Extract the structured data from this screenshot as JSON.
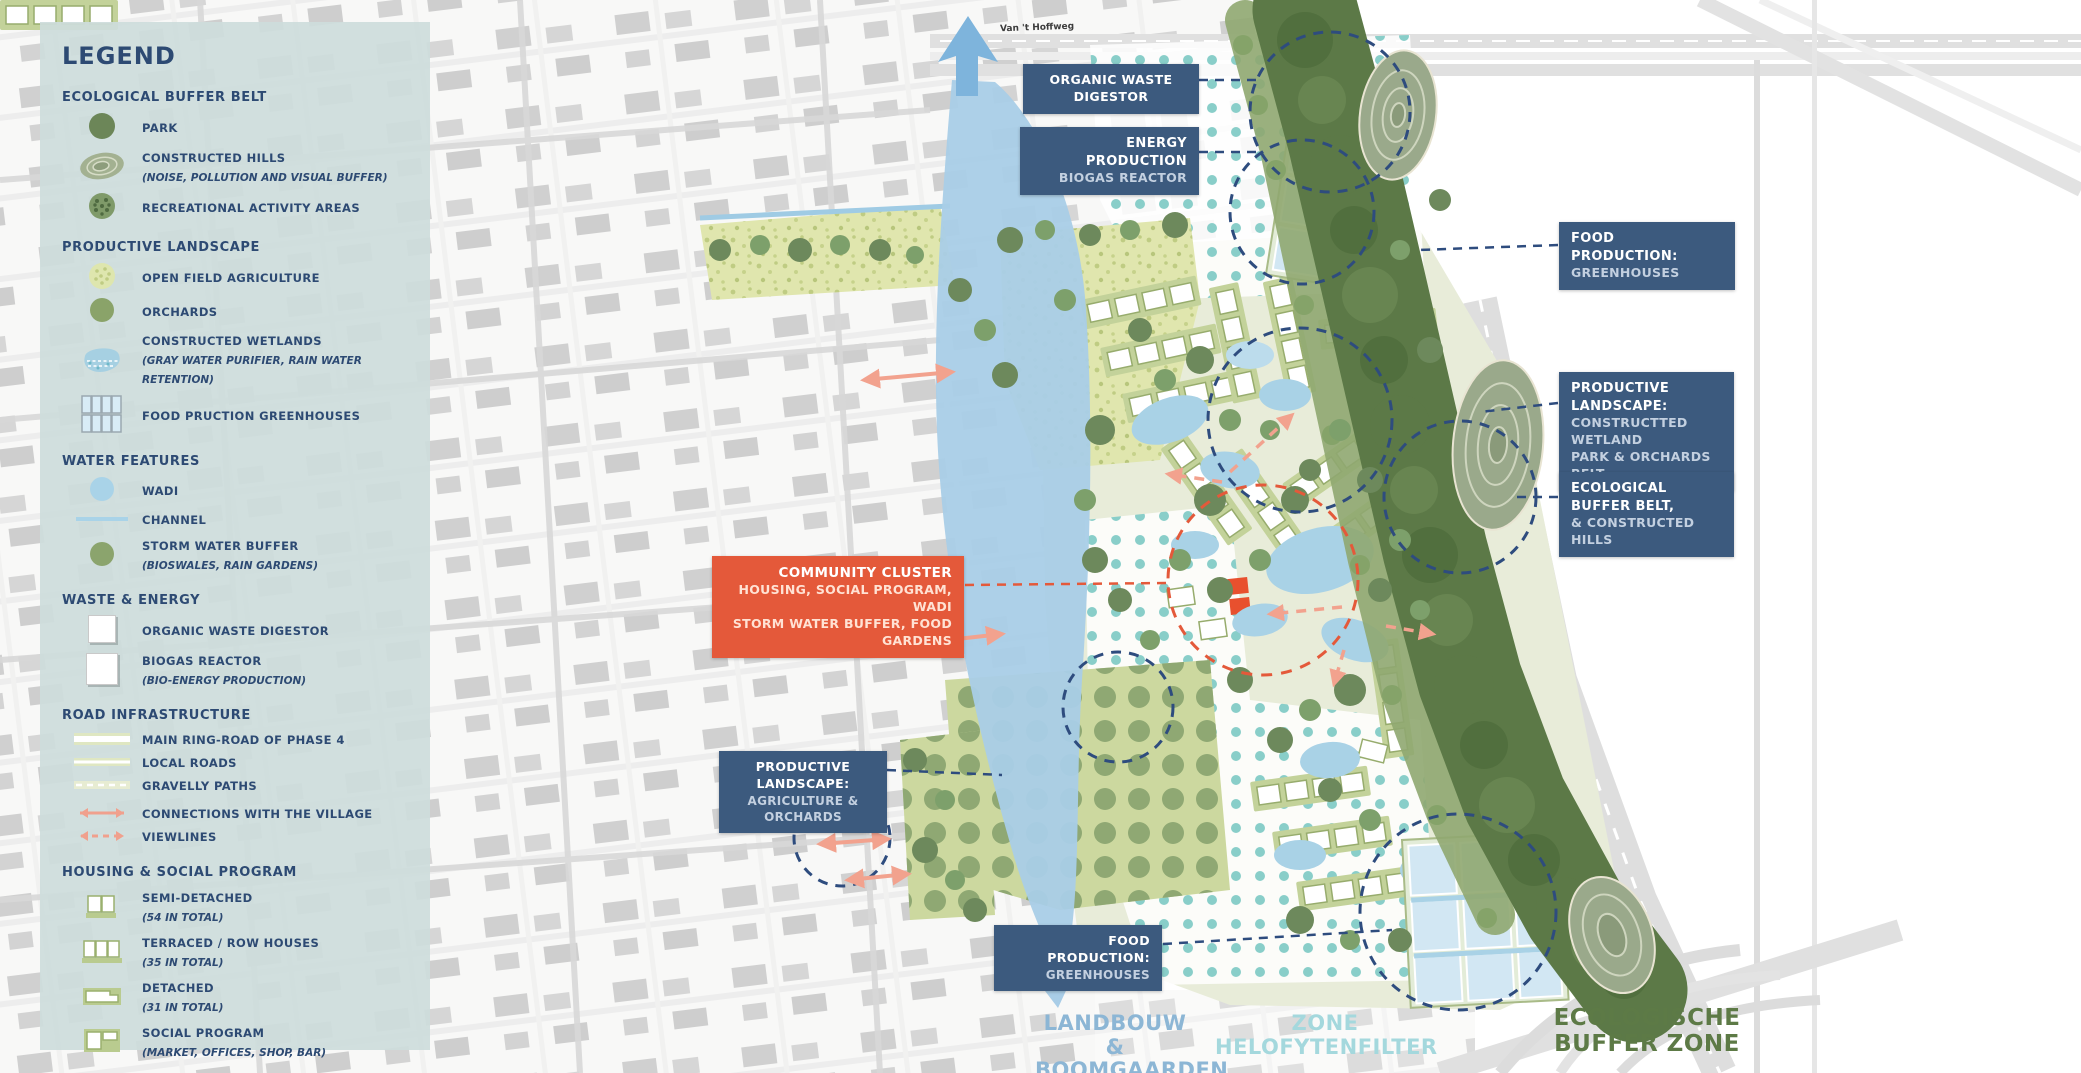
{
  "colors": {
    "navy_text": "#2d4a73",
    "label_box": "#3c5a7e",
    "label_secondary": "#c3d0e0",
    "accent_orange": "#e4593a",
    "legend_bg": "#cddddc",
    "channel_blue": "#a9cde7",
    "wadi_blue": "#a9d2e6",
    "helofyten_dot": "#89cec9",
    "agriculture": "#e0e6ae",
    "orchard": "#8fa873",
    "buffer_green": "#5c7947",
    "landbouw_text": "#8cb6d5",
    "helofyten_text": "#a4d8dd",
    "ecologische_text": "#5d7a46"
  },
  "legend": {
    "title": "LEGEND",
    "sections": [
      {
        "heading": "ECOLOGICAL BUFFER BELT",
        "items": [
          {
            "label": "PARK",
            "sub": ""
          },
          {
            "label": "CONSTRUCTED HILLS",
            "sub": "(NOISE, POLLUTION AND VISUAL BUFFER)"
          },
          {
            "label": "RECREATIONAL ACTIVITY AREAS",
            "sub": ""
          }
        ]
      },
      {
        "heading": "PRODUCTIVE LANDSCAPE",
        "items": [
          {
            "label": "OPEN FIELD AGRICULTURE",
            "sub": ""
          },
          {
            "label": "ORCHARDS",
            "sub": ""
          },
          {
            "label": "CONSTRUCTED WETLANDS",
            "sub": "(GRAY WATER PURIFIER, RAIN WATER RETENTION)"
          },
          {
            "label": "FOOD PRUCTION GREENHOUSES",
            "sub": ""
          }
        ]
      },
      {
        "heading": "WATER FEATURES",
        "items": [
          {
            "label": "WADI",
            "sub": ""
          },
          {
            "label": "CHANNEL",
            "sub": ""
          },
          {
            "label": "STORM WATER BUFFER",
            "sub": "(BIOSWALES, RAIN GARDENS)"
          }
        ]
      },
      {
        "heading": "WASTE & ENERGY",
        "items": [
          {
            "label": "ORGANIC WASTE DIGESTOR",
            "sub": ""
          },
          {
            "label": "BIOGAS REACTOR",
            "sub": "(BIO-ENERGY PRODUCTION)"
          }
        ]
      },
      {
        "heading": "ROAD INFRASTRUCTURE",
        "items": [
          {
            "label": "MAIN RING-ROAD OF PHASE 4",
            "sub": ""
          },
          {
            "label": "LOCAL ROADS",
            "sub": ""
          },
          {
            "label": "GRAVELLY PATHS",
            "sub": ""
          },
          {
            "label": "CONNECTIONS WITH THE VILLAGE",
            "sub": ""
          },
          {
            "label": "VIEWLINES",
            "sub": ""
          }
        ]
      },
      {
        "heading": "HOUSING & SOCIAL PROGRAM",
        "items": [
          {
            "label": "SEMI-DETACHED",
            "sub": "(54 IN TOTAL)"
          },
          {
            "label": "TERRACED / ROW HOUSES",
            "sub": "(35 IN TOTAL)"
          },
          {
            "label": "DETACHED",
            "sub": "(31 IN TOTAL)"
          },
          {
            "label": "SOCIAL PROGRAM",
            "sub": "(MARKET, OFFICES, SHOP, BAR)"
          }
        ]
      }
    ]
  },
  "map_labels": {
    "organic": {
      "l1": "ORGANIC WASTE DIGESTOR"
    },
    "energy": {
      "l1": "ENERGY PRODUCTION",
      "l2": "BIOGAS REACTOR"
    },
    "food_top": {
      "l1": "FOOD PRODUCTION:",
      "l2": "GREENHOUSES"
    },
    "prod_right": {
      "l1": "PRODUCTIVE LANDSCAPE:",
      "l2": "CONSTRUCTTED WETLAND",
      "l3": "PARK & ORCHARDS BELT"
    },
    "buffer_right": {
      "l1": "ECOLOGICAL BUFFER BELT,",
      "l2": "& CONSTRUCTED HILLS"
    },
    "community": {
      "l1": "COMMUNITY CLUSTER",
      "l2": "HOUSING, SOCIAL PROGRAM, WADI",
      "l3": "STORM WATER BUFFER, FOOD GARDENS"
    },
    "prod_bottom": {
      "l1": "PRODUCTIVE LANDSCAPE:",
      "l2": "AGRICULTURE & ORCHARDS"
    },
    "food_bottom": {
      "l1": "FOOD PRODUCTION:",
      "l2": "GREENHOUSES"
    }
  },
  "zones": {
    "landbouw": {
      "l1": "LANDBOUW &",
      "l2": "BOOMGAARDEN"
    },
    "helofyten": {
      "l1": "ZONE",
      "l2": "HELOFYTENFILTER"
    },
    "eco": {
      "l1": "ECOLOGISCHE",
      "l2": "BUFFER ZONE"
    }
  },
  "street_label": "Van 't Hoffweg"
}
